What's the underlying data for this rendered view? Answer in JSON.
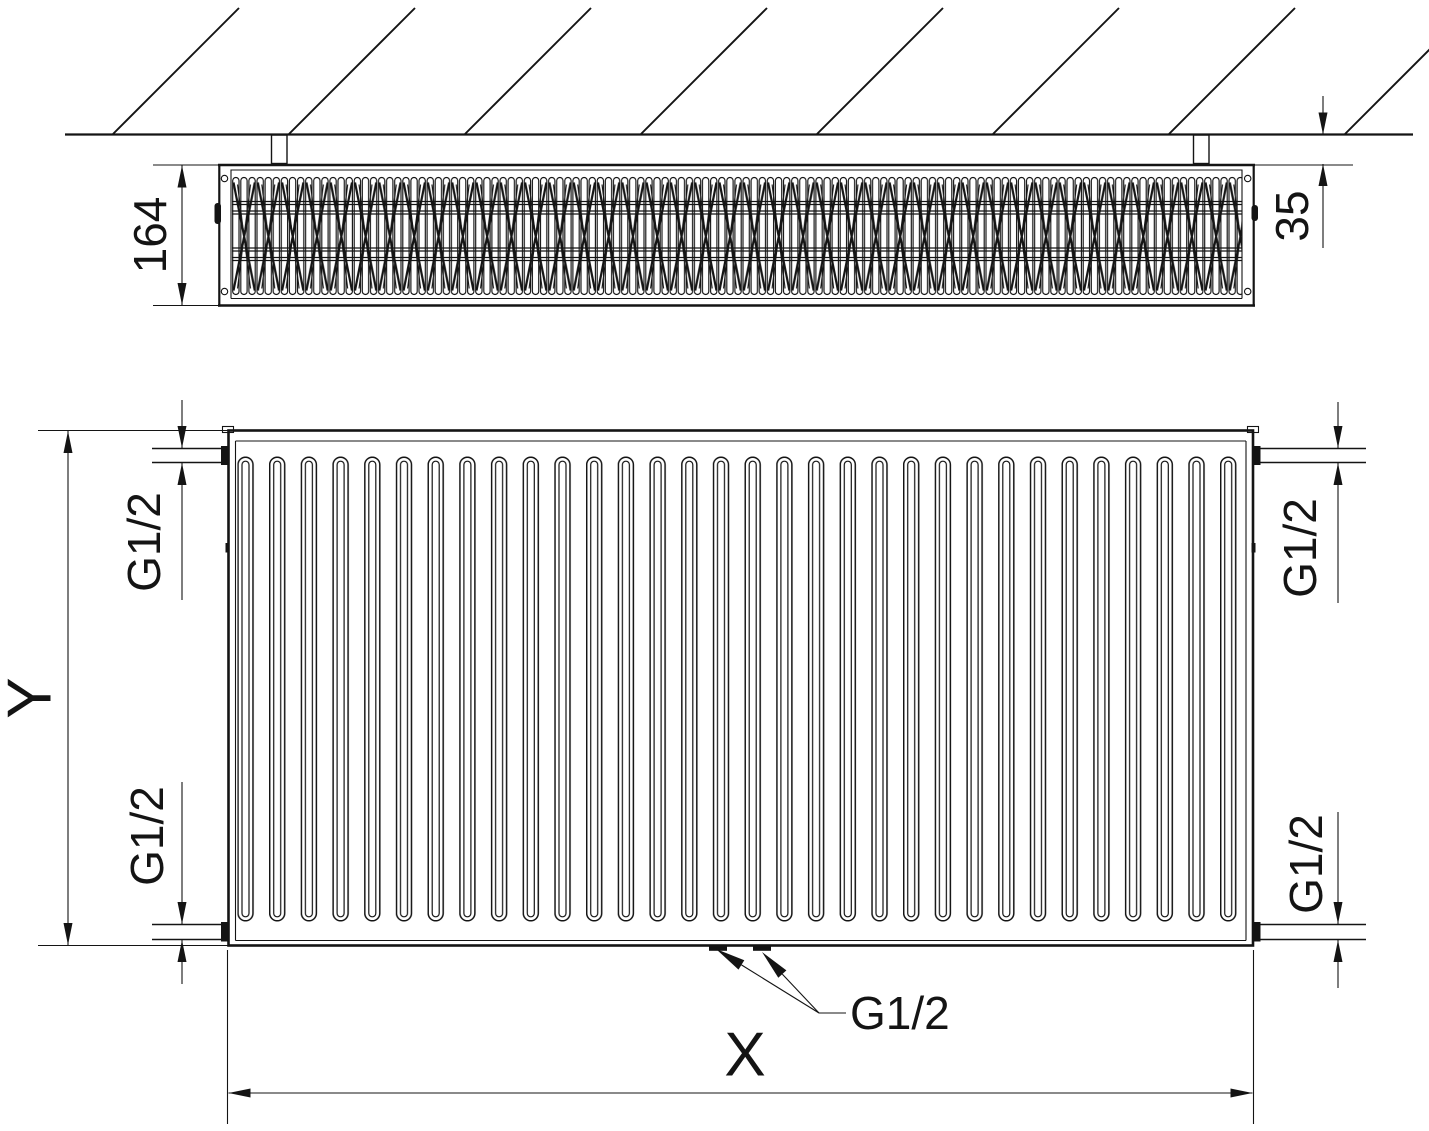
{
  "page": {
    "background": "#ffffff",
    "line_color": "#141414",
    "text_color": "#141414"
  },
  "top_view": {
    "depth_dim": "164",
    "wall_gap_dim": "35"
  },
  "front_view": {
    "height_dim": "Y",
    "width_dim": "X",
    "thread_top_left": "G1/2",
    "thread_top_right": "G1/2",
    "thread_bottom_left": "G1/2",
    "thread_bottom_right": "G1/2",
    "thread_bottom_center": "G1/2"
  }
}
